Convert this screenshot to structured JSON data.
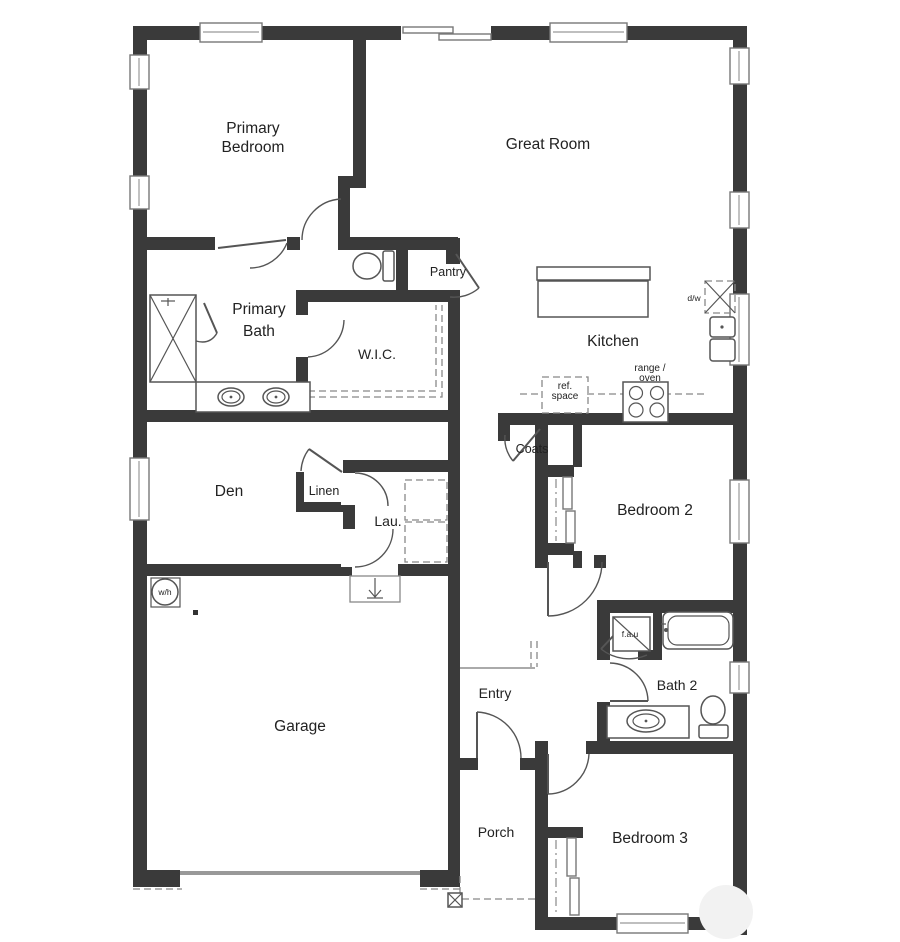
{
  "plan_title": "Single story floor plan",
  "rooms": {
    "primary_bedroom": {
      "line1": "Primary",
      "line2": "Bedroom"
    },
    "great_room": {
      "label": "Great Room"
    },
    "primary_bath": {
      "line1": "Primary",
      "line2": "Bath"
    },
    "wic": {
      "label": "W.I.C."
    },
    "pantry": {
      "label": "Pantry"
    },
    "kitchen": {
      "label": "Kitchen"
    },
    "den": {
      "label": "Den"
    },
    "linen": {
      "label": "Linen"
    },
    "laundry": {
      "label": "Lau."
    },
    "coats": {
      "label": "Coats"
    },
    "bedroom2": {
      "label": "Bedroom 2"
    },
    "bath2": {
      "label": "Bath 2"
    },
    "bedroom3": {
      "label": "Bedroom 3"
    },
    "garage": {
      "label": "Garage"
    },
    "entry": {
      "label": "Entry"
    },
    "porch": {
      "label": "Porch"
    }
  },
  "fixtures": {
    "dishwasher": "d/w",
    "range_oven": {
      "line1": "range /",
      "line2": "oven"
    },
    "ref_space": {
      "line1": "ref.",
      "line2": "space"
    },
    "water_heater": "w/h",
    "fau": "f.a.u"
  },
  "colors": {
    "wall": "#3a3a3a",
    "fixture_line": "#555555",
    "dash_line": "#888888",
    "text": "#222222",
    "background": "#ffffff"
  }
}
